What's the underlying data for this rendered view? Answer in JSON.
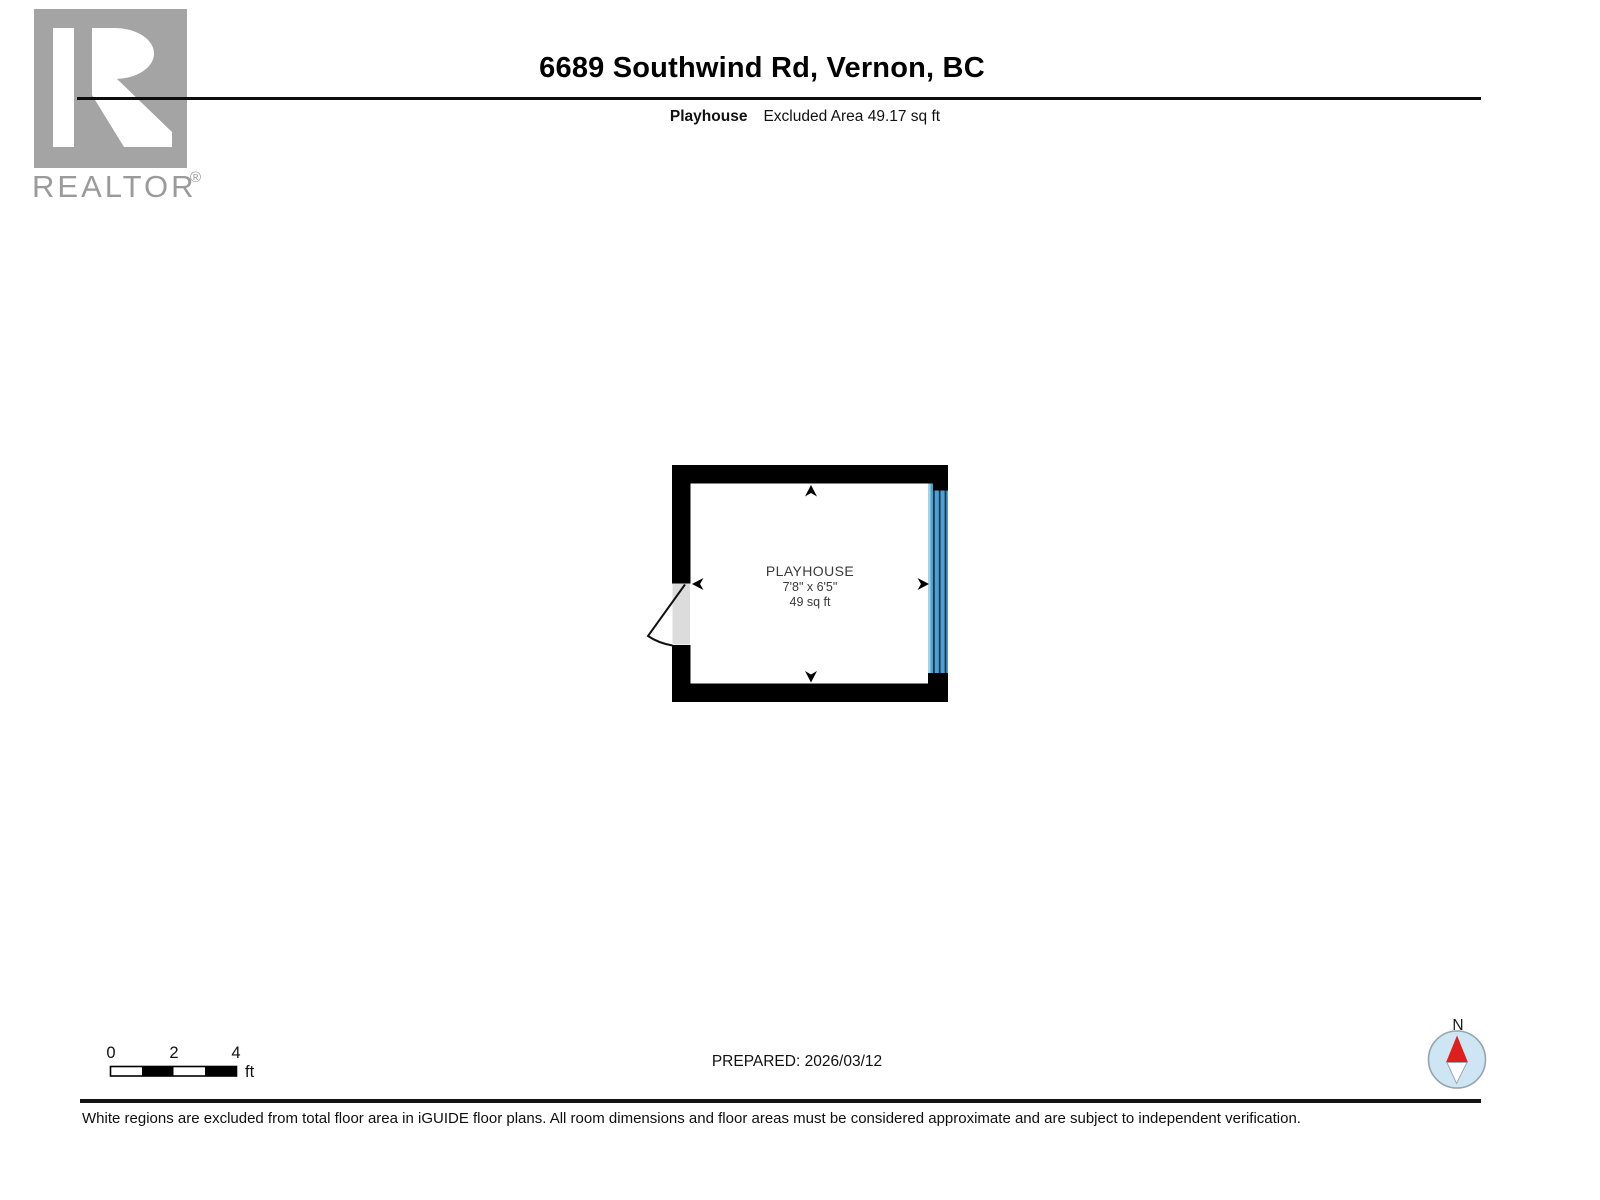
{
  "header": {
    "title": "6689 Southwind Rd, Vernon, BC",
    "subtitle_room": "Playhouse",
    "subtitle_area": "Excluded Area 49.17 sq ft"
  },
  "logo": {
    "brand": "REALTOR",
    "registered": "®"
  },
  "floor_plan": {
    "room": {
      "name": "PLAYHOUSE",
      "dimensions": "7'8\" x 6'5\"",
      "area": "49 sq ft"
    },
    "wall_color": "#000000",
    "window_color": "#4f9fd1",
    "window_edge_color": "#9fd4ea",
    "window_line_color": "#16394f",
    "door_color": "#dcdcdc"
  },
  "scale_bar": {
    "ticks": [
      "0",
      "2",
      "4"
    ],
    "unit": "ft"
  },
  "footer": {
    "prepared": "PREPARED: 2026/03/12",
    "compass_label": "N",
    "disclaimer": "White regions are excluded from total floor area in iGUIDE floor plans. All room dimensions and floor areas must be considered approximate and are subject to independent verification."
  }
}
